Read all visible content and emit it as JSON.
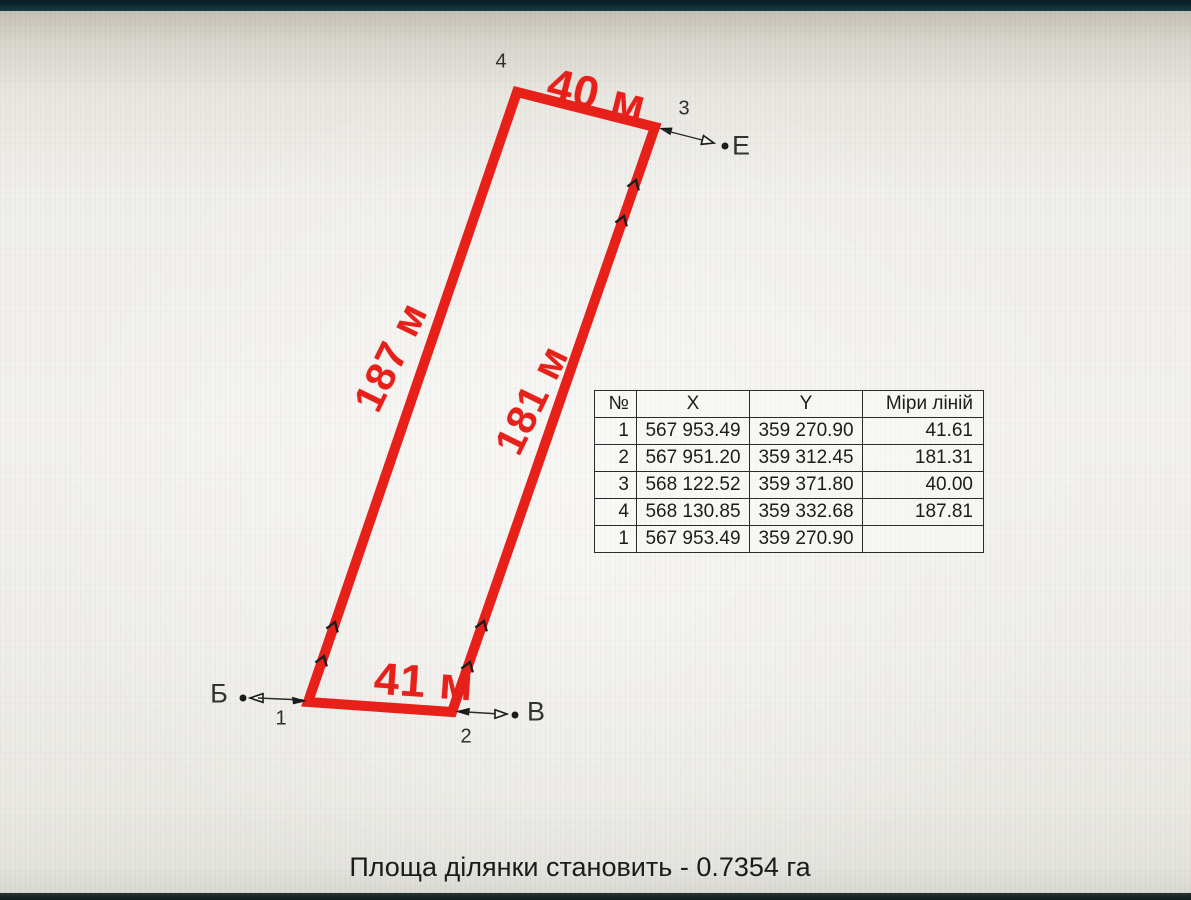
{
  "parcel": {
    "outline_color": "#e8201a",
    "side_measurements": {
      "top": "40 м",
      "left": "187 м",
      "right": "181 м",
      "bottom": "41 м"
    },
    "vertex_numbers": {
      "v1": "1",
      "v2": "2",
      "v3": "3",
      "v4": "4"
    },
    "adjacent_points": {
      "west": "Б",
      "south": "В",
      "east": "Е"
    }
  },
  "coordinate_table": {
    "headers": [
      "№",
      "X",
      "Y",
      "Міри ліній"
    ],
    "rows": [
      [
        "1",
        "567 953.49",
        "359 270.90",
        "41.61"
      ],
      [
        "2",
        "567 951.20",
        "359 312.45",
        "181.31"
      ],
      [
        "3",
        "568 122.52",
        "359 371.80",
        "40.00"
      ],
      [
        "4",
        "568 130.85",
        "359 332.68",
        "187.81"
      ],
      [
        "1",
        "567 953.49",
        "359 270.90",
        ""
      ]
    ]
  },
  "document": {
    "caption": "Площа ділянки становить - 0.7354 га"
  }
}
